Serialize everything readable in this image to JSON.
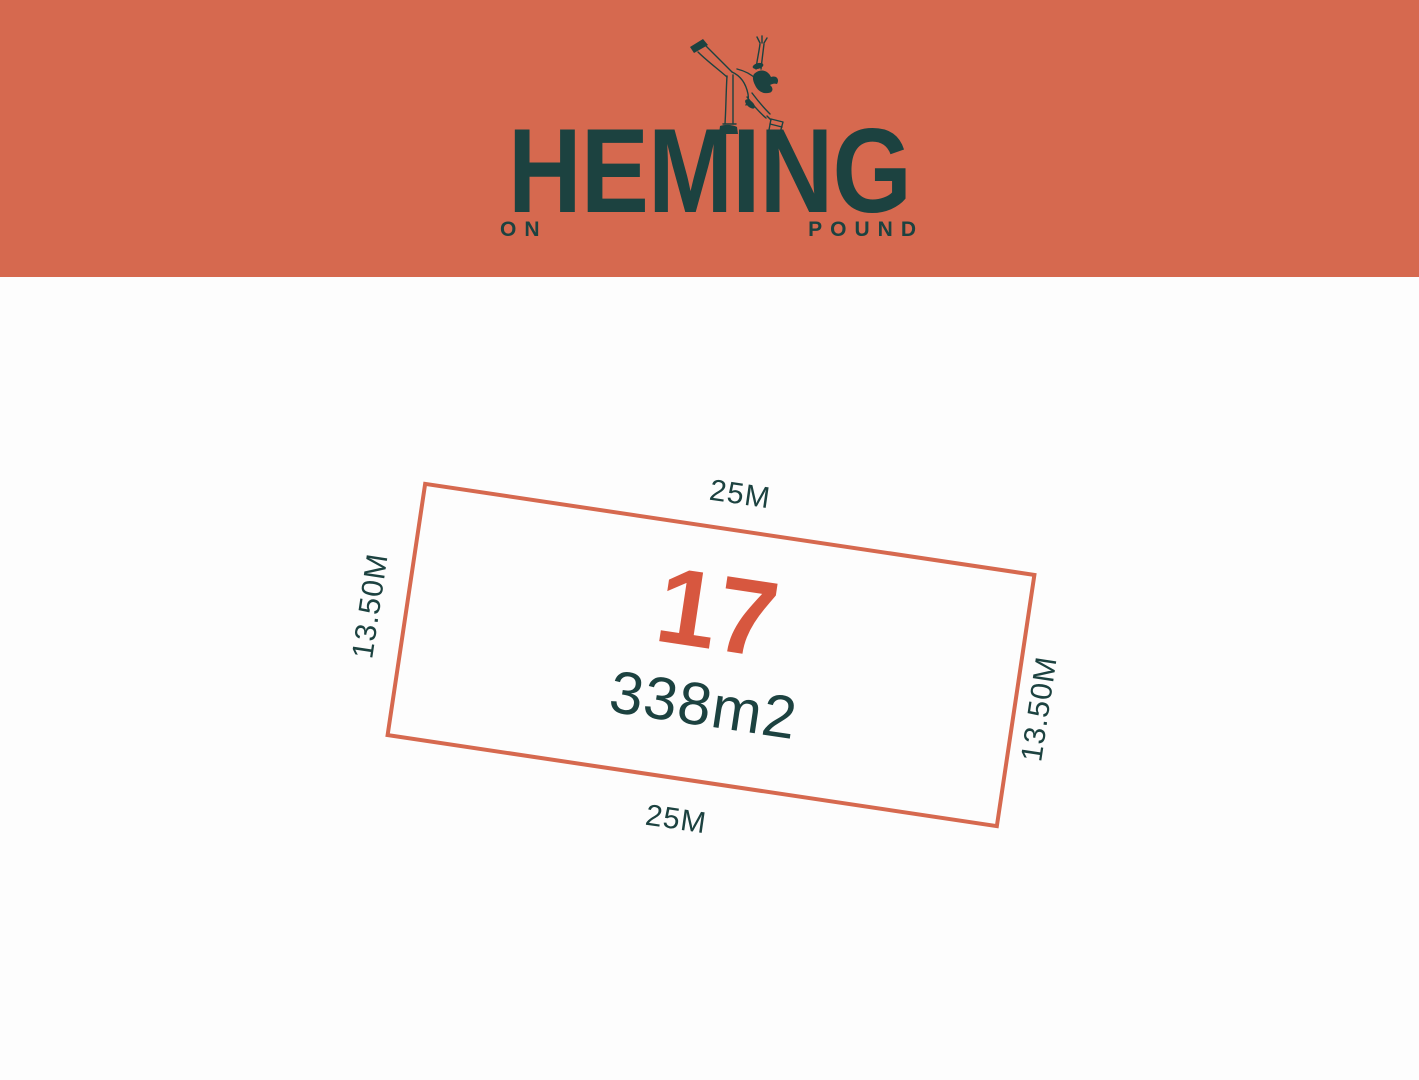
{
  "header": {
    "brand_name": "HEMING",
    "sub_left": "ON",
    "sub_right": "POUND",
    "dancer_icon": "high-kick-dancer-line-art"
  },
  "lot_plan": {
    "lot_number": "17",
    "area": "338m2",
    "dim_top": "25M",
    "dim_bottom": "25M",
    "dim_left": "13.50M",
    "dim_right": "13.50M"
  },
  "colors": {
    "band": "#d6694f",
    "teal": "#1c4240",
    "lot-border": "#d6694f",
    "lot-number": "#d7573f",
    "page-bg": "#fdfdfd"
  }
}
